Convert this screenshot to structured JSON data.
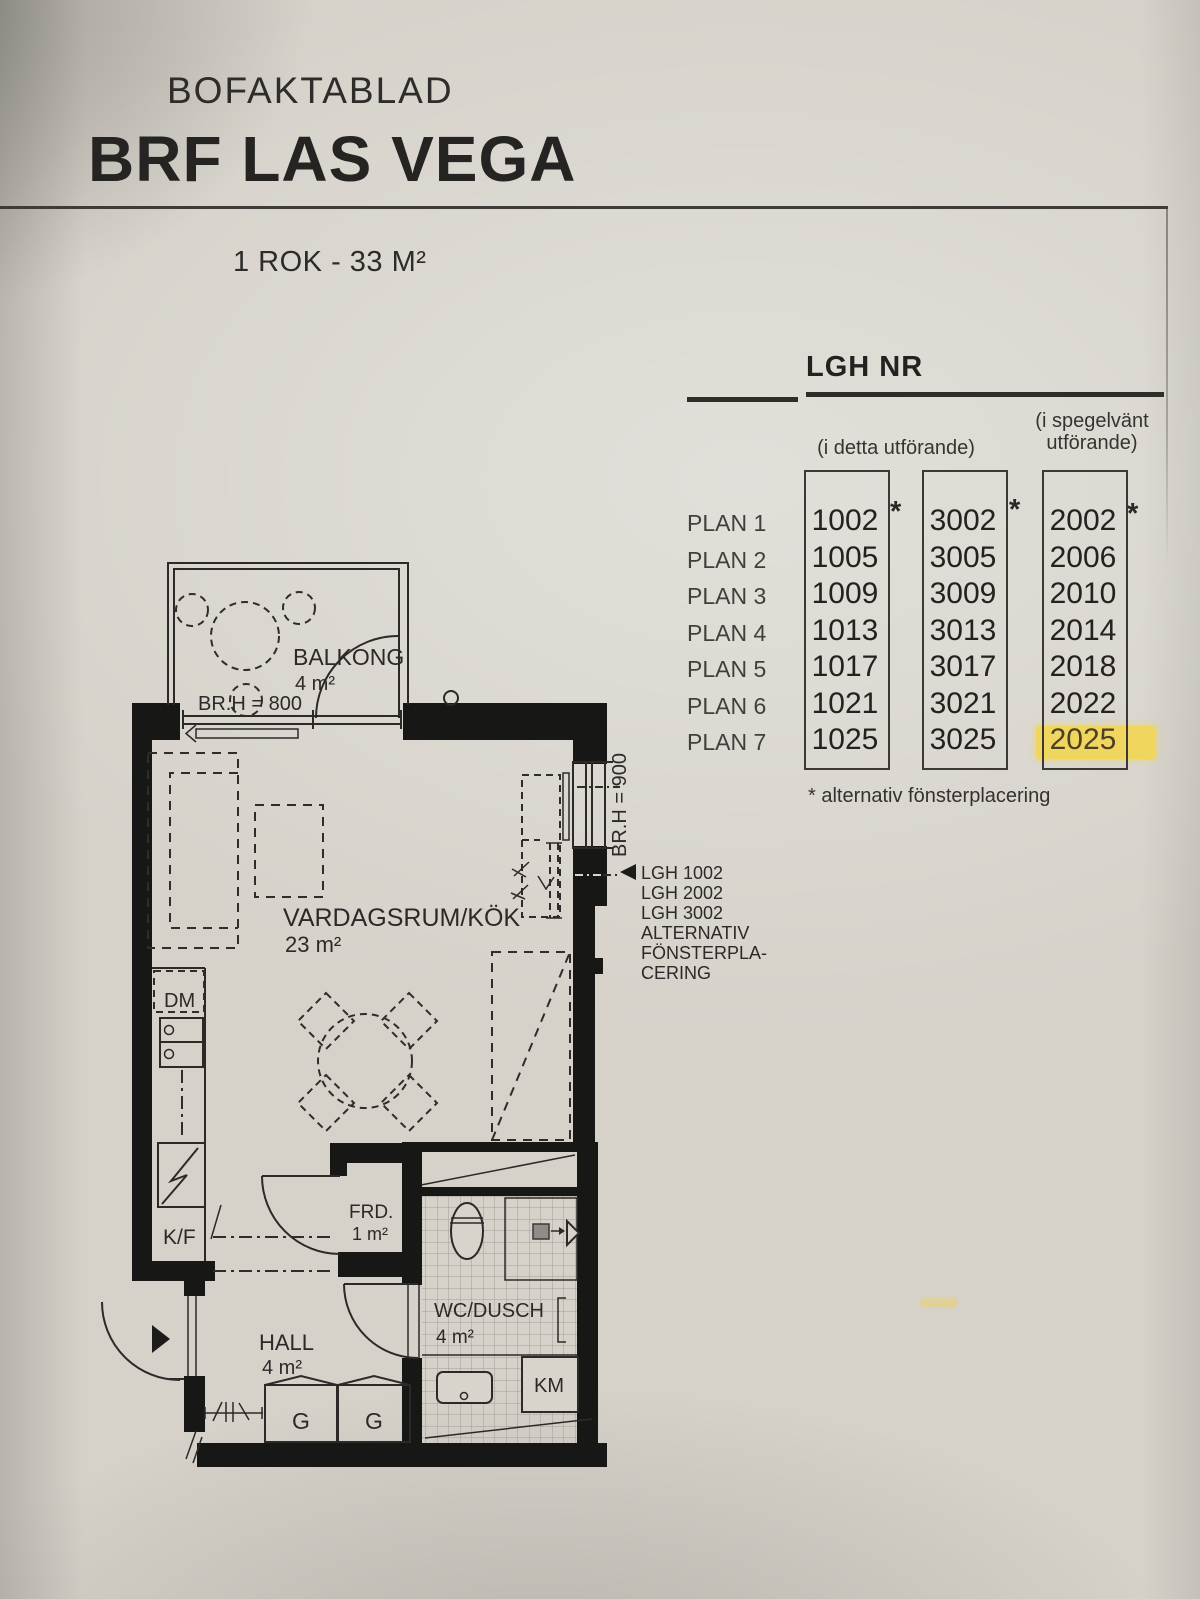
{
  "header": {
    "kicker": "BOFAKTABLAD",
    "title": "BRF LAS VEGA",
    "subtitle": "1 ROK - 33 M²"
  },
  "table": {
    "heading": "LGH NR",
    "col_group_left": "(i detta utförande)",
    "col_group_right_line1": "(i spegelvänt",
    "col_group_right_line2": "utförande)",
    "asterisk": "*",
    "footnote": "* alternativ fönsterplacering",
    "highlight_color": "#f0d65f",
    "plans": [
      "PLAN 1",
      "PLAN 2",
      "PLAN 3",
      "PLAN 4",
      "PLAN 5",
      "PLAN 6",
      "PLAN 7"
    ],
    "col1": [
      "1002",
      "1005",
      "1009",
      "1013",
      "1017",
      "1021",
      "1025"
    ],
    "col2": [
      "3002",
      "3005",
      "3009",
      "3013",
      "3017",
      "3021",
      "3025"
    ],
    "col3": [
      "2002",
      "2006",
      "2010",
      "2014",
      "2018",
      "2022",
      "2025"
    ],
    "highlighted_value": "2025"
  },
  "floorplan": {
    "balcony": {
      "label": "BALKONG",
      "area": "4 m²",
      "note": "BR.H = 800"
    },
    "living_room": {
      "label": "VARDAGSRUM/KÖK",
      "area": "23 m²"
    },
    "window_note": "BR.H = 900",
    "alt_window_lines": [
      "LGH 1002",
      "LGH 2002",
      "LGH 3002",
      "ALTERNATIV",
      "FÖNSTERPLA-",
      "CERING"
    ],
    "dishwasher": "DM",
    "fridge_freezer": "K/F",
    "storage": {
      "label": "FRD.",
      "area": "1 m²"
    },
    "hall": {
      "label": "HALL",
      "area": "4 m²"
    },
    "bathroom": {
      "label": "WC/DUSCH",
      "area": "4 m²"
    },
    "wardrobe_left": "G",
    "wardrobe_right": "G",
    "washing_machine": "KM"
  }
}
